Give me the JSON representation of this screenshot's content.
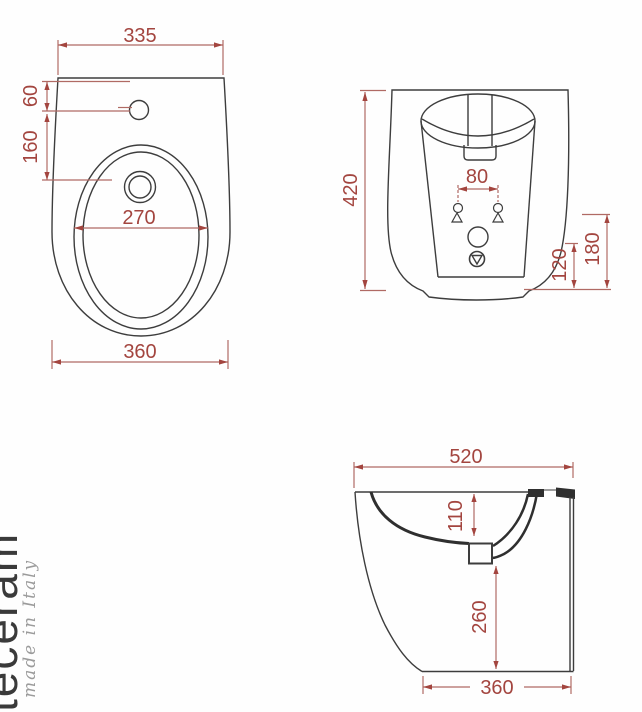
{
  "watermark": {
    "brand": "teceram",
    "origin": "made in Italy"
  },
  "colors": {
    "dimension_red": "#a3453f",
    "drawing_line": "#3d3d3d",
    "background": "#fefefe"
  },
  "dimensions": {
    "plan": {
      "width_top": "335",
      "faucet_offset": "60",
      "faucet_to_drain": "160",
      "bowl_width": "270",
      "width_bottom": "360"
    },
    "front": {
      "height": "420",
      "fixing_hole_spacing": "80",
      "drain_height": "120",
      "inlet_height": "180"
    },
    "side": {
      "depth": "520",
      "rim_to_drain": "110",
      "drain_to_floor": "260",
      "base_depth": "360"
    }
  }
}
